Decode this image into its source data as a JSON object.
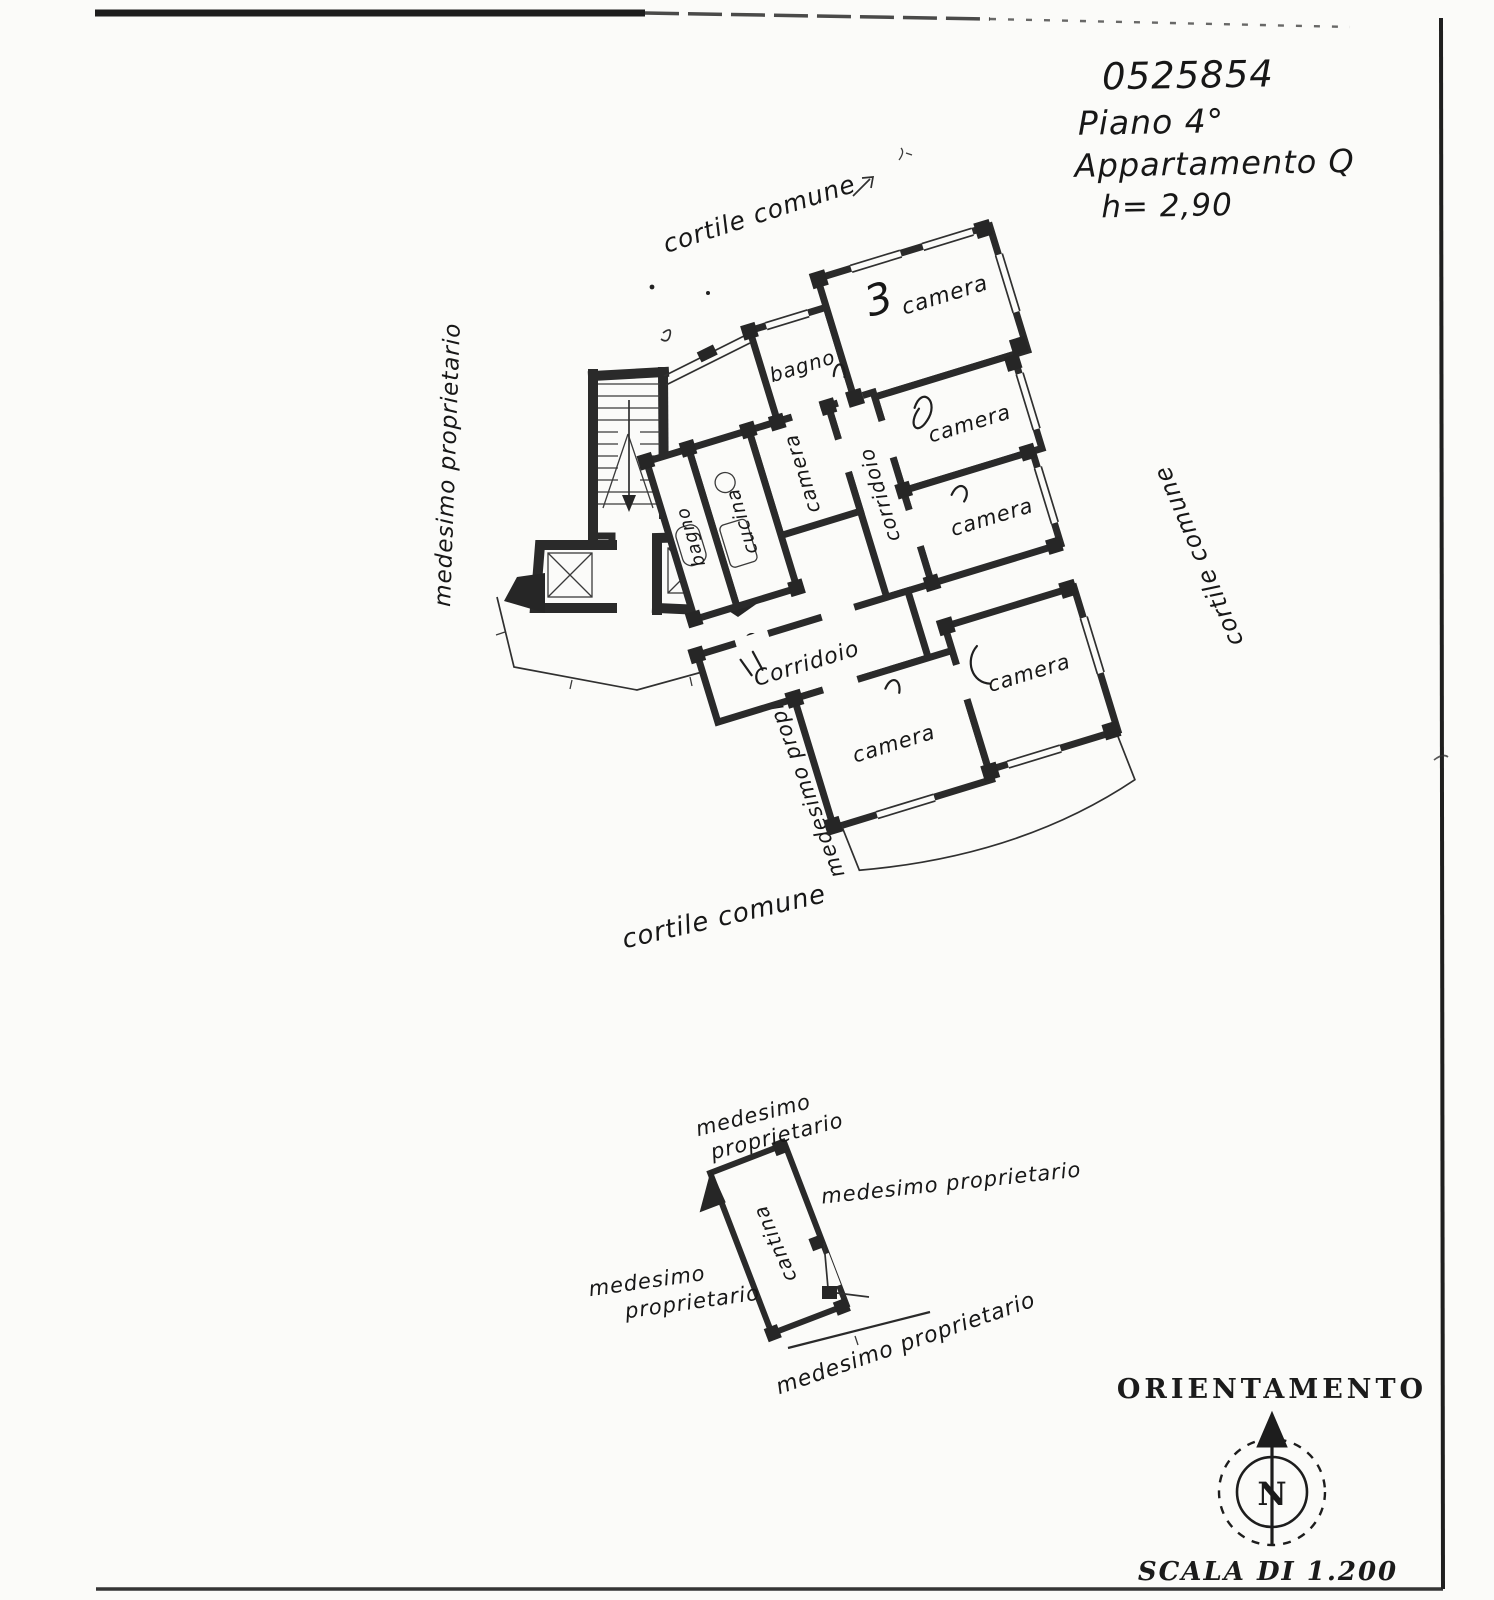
{
  "document": {
    "header": {
      "code": "0525854",
      "floor": "Piano 4°",
      "unit": "Appartamento Q",
      "ceiling_height": "h= 2,90"
    },
    "plan": {
      "bagno_top": "bagno",
      "camera_big": "camera",
      "camera_big_no": "3",
      "camera_mid_a": "camera",
      "camera_mid_b": "camera",
      "corridoio_v": "corridoio",
      "corridoio_main": "Corridoio",
      "camera_bottom_a": "camera",
      "camera_bottom_b": "camera",
      "camera_side": "camera",
      "cucina": "cucina",
      "bagno_stairs": "bagno"
    },
    "context": {
      "courtyard_top": "cortile comune",
      "courtyard_right": "cortile comune",
      "courtyard_bottom": "cortile comune",
      "owner_left": "medesimo proprietario",
      "owner_edge": "medesimo proprietario"
    },
    "cellar": {
      "room_label": "cantina",
      "owner_top_1": "medesimo",
      "owner_top_2": "proprietario",
      "owner_right": "medesimo proprietario",
      "owner_left_1": "medesimo",
      "owner_left_2": "proprietario",
      "owner_bottom": "medesimo proprietario"
    },
    "orientation": {
      "title": "ORIENTAMENTO",
      "north": "N",
      "scale": "SCALA DI 1.200"
    }
  }
}
